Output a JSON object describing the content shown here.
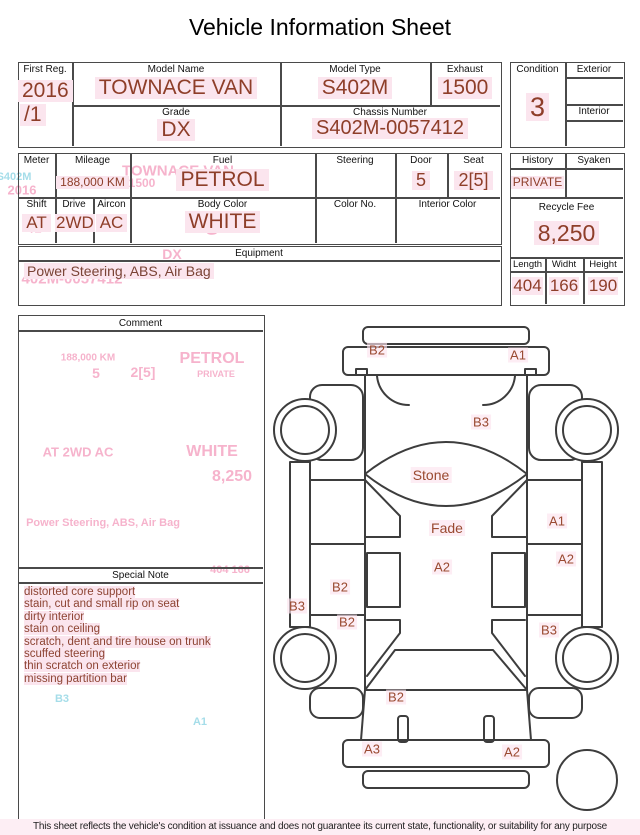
{
  "colors": {
    "value_text": "#8e3e29",
    "highlight": "#fbe5ee",
    "ghost_pink": "#f6b3cc",
    "ghost_cyan": "#a5dde9",
    "border": "#4a4a4a",
    "footer_bg": "#fdeef4"
  },
  "title": "Vehicle Information Sheet",
  "table1": {
    "first_reg_label": "First Reg.",
    "first_reg_line1": "2016",
    "first_reg_line2": "/1",
    "model_name_label": "Model Name",
    "model_name": "TOWNACE VAN",
    "model_type_label": "Model Type",
    "model_type": "S402M",
    "exhaust_label": "Exhaust",
    "exhaust": "1500",
    "grade_label": "Grade",
    "grade": "DX",
    "chassis_label": "Chassis Number",
    "chassis": "S402M-0057412"
  },
  "condition_box": {
    "condition_label": "Condition",
    "condition": "3",
    "exterior_label": "Exterior",
    "exterior": "",
    "interior_label": "Interior",
    "interior": ""
  },
  "table2": {
    "meter_label": "Meter",
    "meter": "",
    "mileage_label": "Mileage",
    "mileage": "188,000 KM",
    "fuel_label": "Fuel",
    "fuel": "PETROL",
    "steering_label": "Steering",
    "steering": "",
    "door_label": "Door",
    "door": "5",
    "seat_label": "Seat",
    "seat": "2[5]",
    "shift_label": "Shift",
    "shift": "AT",
    "drive_label": "Drive",
    "drive": "2WD",
    "aircon_label": "Aircon",
    "aircon": "AC",
    "body_color_label": "Body Color",
    "body_color": "WHITE",
    "color_no_label": "Color No.",
    "color_no": "",
    "interior_color_label": "Interior Color",
    "interior_color": ""
  },
  "equipment": {
    "label": "Equipment",
    "value": "Power Steering, ABS, Air Bag"
  },
  "history_box": {
    "history_label": "History",
    "history": "PRIVATE",
    "syaken_label": "Syaken",
    "syaken": "",
    "recycle_label": "Recycle Fee",
    "recycle_fee": "8,250",
    "length_label": "Length",
    "length": "404",
    "width_label": "Widht",
    "width": "166",
    "height_label": "Height",
    "height": "190"
  },
  "comment": {
    "label": "Comment"
  },
  "special_note": {
    "label": "Special Note",
    "items": [
      "distorted core support",
      "stain, cut and small rip on seat",
      "dirty interior",
      "stain on ceiling",
      "scratch, dent and tire house on trunk",
      "scuffed steering",
      "thin scratch on exterior",
      "missing partition bar"
    ]
  },
  "diagram": {
    "damage_labels": [
      {
        "text": "B2",
        "x": 377,
        "y": 350,
        "size": 13
      },
      {
        "text": "A1",
        "x": 518,
        "y": 355,
        "size": 13
      },
      {
        "text": "B3",
        "x": 481,
        "y": 422,
        "size": 13
      },
      {
        "text": "Stone",
        "x": 431,
        "y": 475,
        "size": 14
      },
      {
        "text": "A1",
        "x": 557,
        "y": 521,
        "size": 13
      },
      {
        "text": "Fade",
        "x": 447,
        "y": 528,
        "size": 14
      },
      {
        "text": "A2",
        "x": 566,
        "y": 559,
        "size": 13
      },
      {
        "text": "A2",
        "x": 442,
        "y": 567,
        "size": 13
      },
      {
        "text": "B2",
        "x": 340,
        "y": 587,
        "size": 13
      },
      {
        "text": "B3",
        "x": 297,
        "y": 606,
        "size": 13
      },
      {
        "text": "B2",
        "x": 347,
        "y": 622,
        "size": 13
      },
      {
        "text": "B3",
        "x": 549,
        "y": 630,
        "size": 13
      },
      {
        "text": "B2",
        "x": 396,
        "y": 697,
        "size": 13
      },
      {
        "text": "A3",
        "x": 372,
        "y": 749,
        "size": 13
      },
      {
        "text": "A2",
        "x": 512,
        "y": 752,
        "size": 13
      }
    ]
  },
  "ghost_text": [
    {
      "text": "TOWNACE VAN",
      "x": 178,
      "y": 171,
      "size": 15,
      "tone": "pink"
    },
    {
      "text": "1500",
      "x": 142,
      "y": 183,
      "size": 12,
      "tone": "pink"
    },
    {
      "text": "S402M",
      "x": 14,
      "y": 177,
      "size": 11,
      "tone": "cyan"
    },
    {
      "text": "2016",
      "x": 22,
      "y": 190,
      "size": 13,
      "tone": "pink"
    },
    {
      "text": "/1",
      "x": 36,
      "y": 228,
      "size": 13,
      "tone": "pink"
    },
    {
      "text": "3",
      "x": 212,
      "y": 226,
      "size": 26,
      "tone": "pink"
    },
    {
      "text": "DX",
      "x": 172,
      "y": 254,
      "size": 14,
      "tone": "pink"
    },
    {
      "text": "402M-0057412",
      "x": 72,
      "y": 279,
      "size": 15,
      "tone": "pink"
    },
    {
      "text": "188,000 KM",
      "x": 88,
      "y": 358,
      "size": 10,
      "tone": "pink"
    },
    {
      "text": "PETROL",
      "x": 212,
      "y": 359,
      "size": 16,
      "tone": "pink"
    },
    {
      "text": "5",
      "x": 96,
      "y": 373,
      "size": 14,
      "tone": "pink"
    },
    {
      "text": "2[5]",
      "x": 143,
      "y": 372,
      "size": 14,
      "tone": "pink"
    },
    {
      "text": "PRIVATE",
      "x": 216,
      "y": 374,
      "size": 9,
      "tone": "pink"
    },
    {
      "text": "AT   2WD   AC",
      "x": 78,
      "y": 452,
      "size": 13,
      "tone": "pink"
    },
    {
      "text": "WHITE",
      "x": 212,
      "y": 452,
      "size": 16,
      "tone": "pink"
    },
    {
      "text": "8,250",
      "x": 232,
      "y": 477,
      "size": 16,
      "tone": "pink"
    },
    {
      "text": "Power Steering, ABS, Air Bag",
      "x": 103,
      "y": 523,
      "size": 11,
      "tone": "pink"
    },
    {
      "text": "404  166",
      "x": 230,
      "y": 570,
      "size": 11,
      "tone": "pink"
    },
    {
      "text": "B3",
      "x": 62,
      "y": 699,
      "size": 11,
      "tone": "cyan"
    },
    {
      "text": "A1",
      "x": 200,
      "y": 722,
      "size": 11,
      "tone": "cyan"
    }
  ],
  "footer": "This sheet reflects the vehicle's condition at issuance and does not guarantee its current state, functionality, or suitability for any purpose"
}
